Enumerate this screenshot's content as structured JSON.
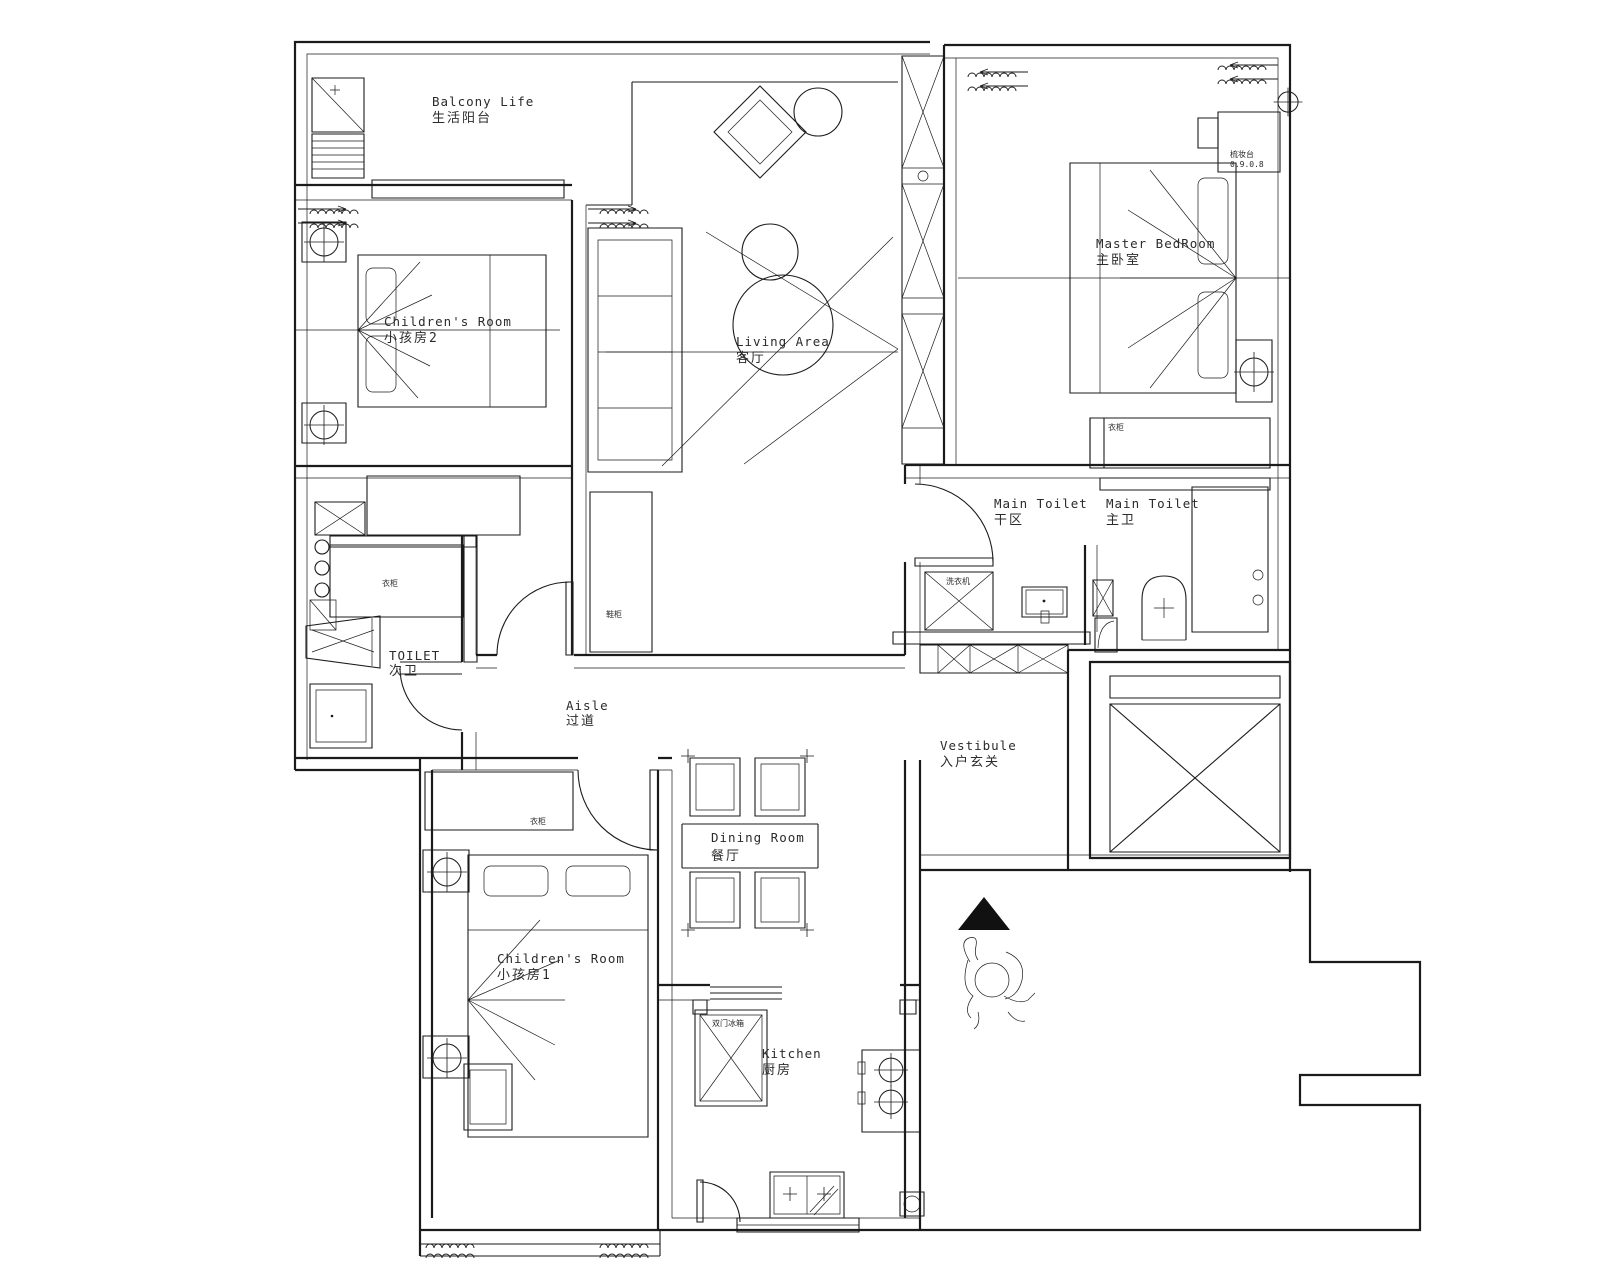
{
  "colors": {
    "ink": "#1b1b1b",
    "background": "#ffffff",
    "fill_black": "#111111"
  },
  "rooms": [
    {
      "id": "balcony",
      "en": "Balcony Life",
      "zh": "生活阳台"
    },
    {
      "id": "childrens-room-2",
      "en": "Children's Room",
      "zh": "小孩房2"
    },
    {
      "id": "living-area",
      "en": "Living Area",
      "zh": "客厅"
    },
    {
      "id": "master-bedroom",
      "en": "Master BedRoom",
      "zh": "主卧室"
    },
    {
      "id": "main-toilet-dry",
      "en": "Main Toilet",
      "zh": "干区"
    },
    {
      "id": "main-toilet",
      "en": "Main Toilet",
      "zh": "主卫"
    },
    {
      "id": "toilet",
      "en": "TOILET",
      "zh": "次卫"
    },
    {
      "id": "aisle",
      "en": "Aisle",
      "zh": "过道"
    },
    {
      "id": "vestibule",
      "en": "Vestibule",
      "zh": "入户玄关"
    },
    {
      "id": "dining-room",
      "en": "Dining Room",
      "zh": "餐厅"
    },
    {
      "id": "childrens-room-1",
      "en": "Children's Room",
      "zh": "小孩房1"
    },
    {
      "id": "kitchen",
      "en": "Kitchen",
      "zh": "厨房"
    }
  ],
  "annotations": {
    "dresser": "梳妆台",
    "dresser_dim": "0.9.0.8",
    "wardrobe_left": "衣柜",
    "wardrobe_child1": "衣柜",
    "shoe_cabinet": "鞋柜",
    "washer": "洗衣机",
    "fridge": "双门冰箱",
    "wardrobe_master": "衣柜"
  }
}
